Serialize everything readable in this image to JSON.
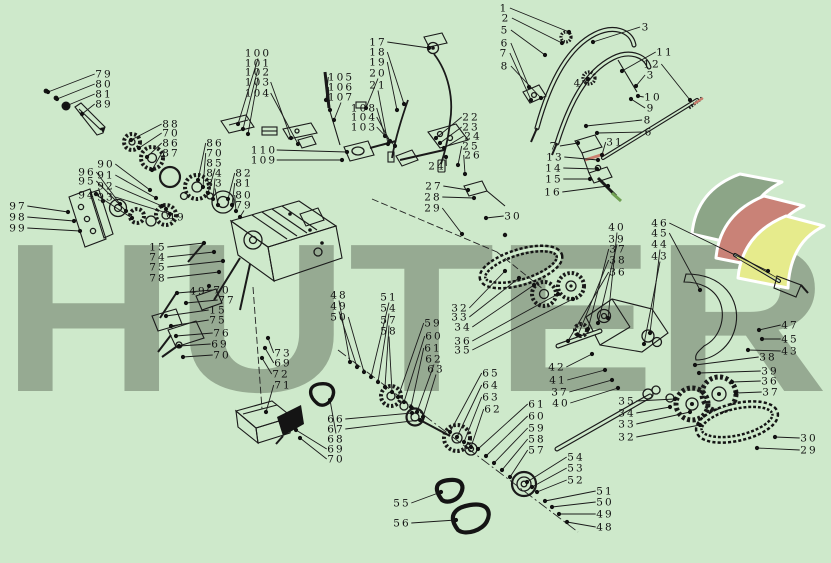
{
  "canvas": {
    "background": "#cee9cb",
    "line_color": "#1a1a1a"
  },
  "watermark": {
    "text": "HUTER",
    "color": "#96aa92"
  },
  "logo": {
    "ribbon_colors": [
      "#8ca587",
      "#c98277",
      "#e6eb8c"
    ]
  },
  "accents": {
    "red_part_color": "#cb7f6e",
    "green_part_color": "#70a052",
    "yellow_lever_color": "#d8dd7a"
  },
  "callouts": [
    {
      "n": "79",
      "x": 104,
      "y": 74,
      "tx": 48,
      "ty": 92
    },
    {
      "n": "80",
      "x": 104,
      "y": 84,
      "tx": 57,
      "ty": 99
    },
    {
      "n": "81",
      "x": 104,
      "y": 94,
      "tx": 66,
      "ty": 106
    },
    {
      "n": "89",
      "x": 104,
      "y": 104,
      "tx": 82,
      "ty": 114
    },
    {
      "n": "88",
      "x": 171,
      "y": 124,
      "tx": 131,
      "ty": 140
    },
    {
      "n": "70",
      "x": 171,
      "y": 133,
      "tx": 139,
      "ty": 148
    },
    {
      "n": "86",
      "x": 171,
      "y": 143,
      "tx": 147,
      "ty": 157
    },
    {
      "n": "87",
      "x": 171,
      "y": 153,
      "tx": 152,
      "ty": 170
    },
    {
      "n": "90",
      "x": 106,
      "y": 164,
      "tx": 150,
      "ty": 190
    },
    {
      "n": "91",
      "x": 106,
      "y": 175,
      "tx": 156,
      "ty": 198
    },
    {
      "n": "92",
      "x": 106,
      "y": 186,
      "tx": 162,
      "ty": 206
    },
    {
      "n": "93",
      "x": 106,
      "y": 197,
      "tx": 170,
      "ty": 214
    },
    {
      "n": "96",
      "x": 87,
      "y": 172,
      "tx": 120,
      "ty": 204
    },
    {
      "n": "95",
      "x": 87,
      "y": 181,
      "tx": 126,
      "ty": 211
    },
    {
      "n": "94",
      "x": 87,
      "y": 195,
      "tx": 132,
      "ty": 218
    },
    {
      "n": "97",
      "x": 18,
      "y": 206,
      "tx": 68,
      "ty": 212
    },
    {
      "n": "98",
      "x": 18,
      "y": 217,
      "tx": 74,
      "ty": 221
    },
    {
      "n": "99",
      "x": 18,
      "y": 228,
      "tx": 80,
      "ty": 231
    },
    {
      "n": "86",
      "x": 215,
      "y": 143,
      "tx": 198,
      "ty": 180
    },
    {
      "n": "70",
      "x": 215,
      "y": 153,
      "tx": 203,
      "ty": 187
    },
    {
      "n": "85",
      "x": 215,
      "y": 163,
      "tx": 208,
      "ty": 193
    },
    {
      "n": "84",
      "x": 215,
      "y": 173,
      "tx": 213,
      "ty": 199
    },
    {
      "n": "83",
      "x": 215,
      "y": 183,
      "tx": 218,
      "ty": 205
    },
    {
      "n": "82",
      "x": 244,
      "y": 173,
      "tx": 228,
      "ty": 199
    },
    {
      "n": "81",
      "x": 244,
      "y": 183,
      "tx": 232,
      "ty": 205
    },
    {
      "n": "80",
      "x": 244,
      "y": 195,
      "tx": 236,
      "ty": 211
    },
    {
      "n": "79",
      "x": 244,
      "y": 205,
      "tx": 240,
      "ty": 217
    },
    {
      "n": "49",
      "x": 177,
      "y": 217,
      "tx": 166,
      "ty": 209
    },
    {
      "n": "49",
      "x": 198,
      "y": 291,
      "tx": 209,
      "ty": 286
    },
    {
      "n": "15",
      "x": 158,
      "y": 247,
      "tx": 204,
      "ty": 243
    },
    {
      "n": "74",
      "x": 158,
      "y": 257,
      "tx": 214,
      "ty": 252
    },
    {
      "n": "75",
      "x": 158,
      "y": 267,
      "tx": 223,
      "ty": 261
    },
    {
      "n": "78",
      "x": 158,
      "y": 278,
      "tx": 219,
      "ty": 272
    },
    {
      "n": "70",
      "x": 222,
      "y": 290,
      "tx": 177,
      "ty": 293
    },
    {
      "n": "77",
      "x": 227,
      "y": 300,
      "tx": 186,
      "ty": 303
    },
    {
      "n": "15",
      "x": 218,
      "y": 310,
      "tx": 166,
      "ty": 316
    },
    {
      "n": "75",
      "x": 218,
      "y": 320,
      "tx": 171,
      "ty": 326
    },
    {
      "n": "76",
      "x": 222,
      "y": 333,
      "tx": 176,
      "ty": 336
    },
    {
      "n": "69",
      "x": 220,
      "y": 344,
      "tx": 179,
      "ty": 346
    },
    {
      "n": "70",
      "x": 222,
      "y": 355,
      "tx": 183,
      "ty": 357
    },
    {
      "n": "73",
      "x": 283,
      "y": 353,
      "tx": 268,
      "ty": 338
    },
    {
      "n": "69",
      "x": 283,
      "y": 363,
      "tx": 265,
      "ty": 348
    },
    {
      "n": "72",
      "x": 281,
      "y": 374,
      "tx": 262,
      "ty": 358
    },
    {
      "n": "71",
      "x": 283,
      "y": 385,
      "tx": 266,
      "ty": 412
    },
    {
      "n": "100",
      "x": 258,
      "y": 53,
      "tx": 238,
      "ty": 124
    },
    {
      "n": "101",
      "x": 258,
      "y": 63,
      "tx": 243,
      "ty": 129
    },
    {
      "n": "102",
      "x": 258,
      "y": 72,
      "tx": 248,
      "ty": 134
    },
    {
      "n": "103",
      "x": 258,
      "y": 82,
      "tx": 291,
      "ty": 138
    },
    {
      "n": "104",
      "x": 258,
      "y": 93,
      "tx": 298,
      "ty": 144
    },
    {
      "n": "105",
      "x": 341,
      "y": 77,
      "tx": 326,
      "ty": 100
    },
    {
      "n": "106",
      "x": 341,
      "y": 87,
      "tx": 330,
      "ty": 110
    },
    {
      "n": "107",
      "x": 341,
      "y": 97,
      "tx": 334,
      "ty": 120
    },
    {
      "n": "108",
      "x": 364,
      "y": 108,
      "tx": 385,
      "ty": 136
    },
    {
      "n": "104",
      "x": 364,
      "y": 117,
      "tx": 390,
      "ty": 141
    },
    {
      "n": "103",
      "x": 364,
      "y": 127,
      "tx": 395,
      "ty": 146
    },
    {
      "n": "110",
      "x": 264,
      "y": 150,
      "tx": 347,
      "ty": 152
    },
    {
      "n": "109",
      "x": 264,
      "y": 160,
      "tx": 342,
      "ty": 160
    },
    {
      "n": "17",
      "x": 378,
      "y": 42,
      "tx": 429,
      "ty": 48
    },
    {
      "n": "18",
      "x": 378,
      "y": 52,
      "tx": 404,
      "ty": 104
    },
    {
      "n": "19",
      "x": 378,
      "y": 62,
      "tx": 397,
      "ty": 110
    },
    {
      "n": "20",
      "x": 378,
      "y": 73,
      "tx": 366,
      "ty": 108
    },
    {
      "n": "21",
      "x": 378,
      "y": 85,
      "tx": 388,
      "ty": 144
    },
    {
      "n": "22",
      "x": 471,
      "y": 117,
      "tx": 436,
      "ty": 138
    },
    {
      "n": "23",
      "x": 471,
      "y": 127,
      "tx": 440,
      "ty": 143
    },
    {
      "n": "24",
      "x": 473,
      "y": 136,
      "tx": 444,
      "ty": 148
    },
    {
      "n": "25",
      "x": 471,
      "y": 146,
      "tx": 458,
      "ty": 165
    },
    {
      "n": "26",
      "x": 473,
      "y": 155,
      "tx": 465,
      "ty": 174
    },
    {
      "n": "24",
      "x": 437,
      "y": 166,
      "tx": 446,
      "ty": 157
    },
    {
      "n": "27",
      "x": 434,
      "y": 186,
      "tx": 468,
      "ty": 190
    },
    {
      "n": "28",
      "x": 433,
      "y": 197,
      "tx": 474,
      "ty": 198
    },
    {
      "n": "29",
      "x": 433,
      "y": 208,
      "tx": 462,
      "ty": 234
    },
    {
      "n": "30",
      "x": 513,
      "y": 216,
      "tx": 486,
      "ty": 218
    },
    {
      "n": "32",
      "x": 460,
      "y": 308,
      "tx": 505,
      "ty": 271
    },
    {
      "n": "33",
      "x": 460,
      "y": 317,
      "tx": 519,
      "ty": 278
    },
    {
      "n": "34",
      "x": 463,
      "y": 327,
      "tx": 534,
      "ty": 285
    },
    {
      "n": "36",
      "x": 463,
      "y": 341,
      "tx": 558,
      "ty": 294
    },
    {
      "n": "35",
      "x": 463,
      "y": 350,
      "tx": 573,
      "ty": 299
    },
    {
      "n": "48",
      "x": 339,
      "y": 295,
      "tx": 350,
      "ty": 362
    },
    {
      "n": "49",
      "x": 339,
      "y": 306,
      "tx": 357,
      "ty": 367
    },
    {
      "n": "50",
      "x": 339,
      "y": 317,
      "tx": 364,
      "ty": 372
    },
    {
      "n": "51",
      "x": 389,
      "y": 297,
      "tx": 371,
      "ty": 377
    },
    {
      "n": "54",
      "x": 389,
      "y": 308,
      "tx": 378,
      "ty": 382
    },
    {
      "n": "57",
      "x": 389,
      "y": 320,
      "tx": 385,
      "ty": 387
    },
    {
      "n": "58",
      "x": 389,
      "y": 331,
      "tx": 392,
      "ty": 392
    },
    {
      "n": "59",
      "x": 433,
      "y": 323,
      "tx": 398,
      "ty": 397
    },
    {
      "n": "60",
      "x": 434,
      "y": 336,
      "tx": 404,
      "ty": 402
    },
    {
      "n": "61",
      "x": 433,
      "y": 348,
      "tx": 411,
      "ty": 407
    },
    {
      "n": "62",
      "x": 434,
      "y": 359,
      "tx": 417,
      "ty": 412
    },
    {
      "n": "63",
      "x": 436,
      "y": 369,
      "tx": 423,
      "ty": 417
    },
    {
      "n": "65",
      "x": 491,
      "y": 373,
      "tx": 450,
      "ty": 432
    },
    {
      "n": "64",
      "x": 491,
      "y": 385,
      "tx": 457,
      "ty": 437
    },
    {
      "n": "63",
      "x": 491,
      "y": 397,
      "tx": 464,
      "ty": 442
    },
    {
      "n": "62",
      "x": 493,
      "y": 409,
      "tx": 471,
      "ty": 447
    },
    {
      "n": "61",
      "x": 537,
      "y": 404,
      "tx": 478,
      "ty": 449
    },
    {
      "n": "60",
      "x": 537,
      "y": 416,
      "tx": 486,
      "ty": 456
    },
    {
      "n": "59",
      "x": 537,
      "y": 428,
      "tx": 494,
      "ty": 463
    },
    {
      "n": "58",
      "x": 537,
      "y": 439,
      "tx": 502,
      "ty": 470
    },
    {
      "n": "57",
      "x": 537,
      "y": 450,
      "tx": 510,
      "ty": 477
    },
    {
      "n": "66",
      "x": 336,
      "y": 419,
      "tx": 412,
      "ty": 413
    },
    {
      "n": "67",
      "x": 336,
      "y": 429,
      "tx": 420,
      "ty": 420
    },
    {
      "n": "68",
      "x": 336,
      "y": 439,
      "tx": 330,
      "ty": 400
    },
    {
      "n": "69",
      "x": 336,
      "y": 449,
      "tx": 296,
      "ty": 430
    },
    {
      "n": "70",
      "x": 336,
      "y": 459,
      "tx": 300,
      "ty": 438
    },
    {
      "n": "55",
      "x": 402,
      "y": 503,
      "tx": 441,
      "ty": 492
    },
    {
      "n": "56",
      "x": 402,
      "y": 523,
      "tx": 456,
      "ty": 520
    },
    {
      "n": "54",
      "x": 576,
      "y": 457,
      "tx": 527,
      "ty": 482
    },
    {
      "n": "53",
      "x": 576,
      "y": 468,
      "tx": 532,
      "ty": 487
    },
    {
      "n": "52",
      "x": 576,
      "y": 480,
      "tx": 537,
      "ty": 492
    },
    {
      "n": "51",
      "x": 605,
      "y": 491,
      "tx": 545,
      "ty": 501
    },
    {
      "n": "50",
      "x": 605,
      "y": 502,
      "tx": 552,
      "ty": 507
    },
    {
      "n": "49",
      "x": 605,
      "y": 514,
      "tx": 559,
      "ty": 514
    },
    {
      "n": "48",
      "x": 605,
      "y": 527,
      "tx": 567,
      "ty": 522
    },
    {
      "n": "42",
      "x": 557,
      "y": 367,
      "tx": 592,
      "ty": 354
    },
    {
      "n": "41",
      "x": 558,
      "y": 380,
      "tx": 605,
      "ty": 370
    },
    {
      "n": "37",
      "x": 560,
      "y": 392,
      "tx": 612,
      "ty": 380
    },
    {
      "n": "40",
      "x": 561,
      "y": 403,
      "tx": 618,
      "ty": 388
    },
    {
      "n": "35",
      "x": 627,
      "y": 401,
      "tx": 675,
      "ty": 399
    },
    {
      "n": "34",
      "x": 627,
      "y": 413,
      "tx": 670,
      "ty": 407
    },
    {
      "n": "33",
      "x": 627,
      "y": 424,
      "tx": 690,
      "ty": 412
    },
    {
      "n": "32",
      "x": 627,
      "y": 437,
      "tx": 700,
      "ty": 425
    },
    {
      "n": "38",
      "x": 768,
      "y": 357,
      "tx": 695,
      "ty": 365
    },
    {
      "n": "39",
      "x": 770,
      "y": 371,
      "tx": 699,
      "ty": 373
    },
    {
      "n": "36",
      "x": 770,
      "y": 381,
      "tx": 732,
      "ty": 382
    },
    {
      "n": "37",
      "x": 771,
      "y": 392,
      "tx": 736,
      "ty": 393
    },
    {
      "n": "30",
      "x": 809,
      "y": 438,
      "tx": 775,
      "ty": 437
    },
    {
      "n": "29",
      "x": 809,
      "y": 450,
      "tx": 757,
      "ty": 448
    },
    {
      "n": "1",
      "x": 504,
      "y": 8,
      "tx": 569,
      "ty": 32
    },
    {
      "n": "2",
      "x": 506,
      "y": 18,
      "tx": 562,
      "ty": 43
    },
    {
      "n": "5",
      "x": 505,
      "y": 30,
      "tx": 545,
      "ty": 55
    },
    {
      "n": "6",
      "x": 505,
      "y": 43,
      "tx": 529,
      "ty": 87
    },
    {
      "n": "7",
      "x": 504,
      "y": 53,
      "tx": 531,
      "ty": 100
    },
    {
      "n": "8",
      "x": 505,
      "y": 66,
      "tx": 541,
      "ty": 98
    },
    {
      "n": "3",
      "x": 646,
      "y": 27,
      "tx": 593,
      "ty": 42
    },
    {
      "n": "11",
      "x": 665,
      "y": 52,
      "tx": 622,
      "ty": 71
    },
    {
      "n": "12",
      "x": 652,
      "y": 64,
      "tx": 690,
      "ty": 100
    },
    {
      "n": "3",
      "x": 651,
      "y": 75,
      "tx": 636,
      "ty": 86
    },
    {
      "n": "10",
      "x": 653,
      "y": 97,
      "tx": 638,
      "ty": 96
    },
    {
      "n": "9",
      "x": 651,
      "y": 108,
      "tx": 631,
      "ty": 99
    },
    {
      "n": "8",
      "x": 648,
      "y": 120,
      "tx": 586,
      "ty": 126
    },
    {
      "n": "6",
      "x": 649,
      "y": 132,
      "tx": 597,
      "ty": 133
    },
    {
      "n": "4",
      "x": 578,
      "y": 83,
      "tx": 588,
      "ty": 79
    },
    {
      "n": "31",
      "x": 615,
      "y": 142,
      "tx": 602,
      "ty": 155
    },
    {
      "n": "7",
      "x": 554,
      "y": 146,
      "tx": 578,
      "ty": 143
    },
    {
      "n": "13",
      "x": 555,
      "y": 157,
      "tx": 598,
      "ty": 160
    },
    {
      "n": "14",
      "x": 554,
      "y": 168,
      "tx": 597,
      "ty": 169
    },
    {
      "n": "15",
      "x": 554,
      "y": 179,
      "tx": 590,
      "ty": 179
    },
    {
      "n": "16",
      "x": 553,
      "y": 192,
      "tx": 608,
      "ty": 186
    },
    {
      "n": "46",
      "x": 660,
      "y": 223,
      "tx": 768,
      "ty": 271
    },
    {
      "n": "45",
      "x": 660,
      "y": 233,
      "tx": 700,
      "ty": 290
    },
    {
      "n": "44",
      "x": 660,
      "y": 244,
      "tx": 650,
      "ty": 333
    },
    {
      "n": "43",
      "x": 660,
      "y": 256,
      "tx": 644,
      "ty": 344
    },
    {
      "n": "40",
      "x": 617,
      "y": 227,
      "tx": 608,
      "ty": 318
    },
    {
      "n": "39",
      "x": 617,
      "y": 239,
      "tx": 598,
      "ty": 323
    },
    {
      "n": "37",
      "x": 618,
      "y": 249,
      "tx": 588,
      "ty": 329
    },
    {
      "n": "38",
      "x": 618,
      "y": 260,
      "tx": 578,
      "ty": 335
    },
    {
      "n": "36",
      "x": 618,
      "y": 272,
      "tx": 568,
      "ty": 341
    },
    {
      "n": "47",
      "x": 790,
      "y": 325,
      "tx": 759,
      "ty": 330
    },
    {
      "n": "45",
      "x": 790,
      "y": 339,
      "tx": 762,
      "ty": 339
    },
    {
      "n": "43",
      "x": 790,
      "y": 351,
      "tx": 748,
      "ty": 350
    }
  ]
}
